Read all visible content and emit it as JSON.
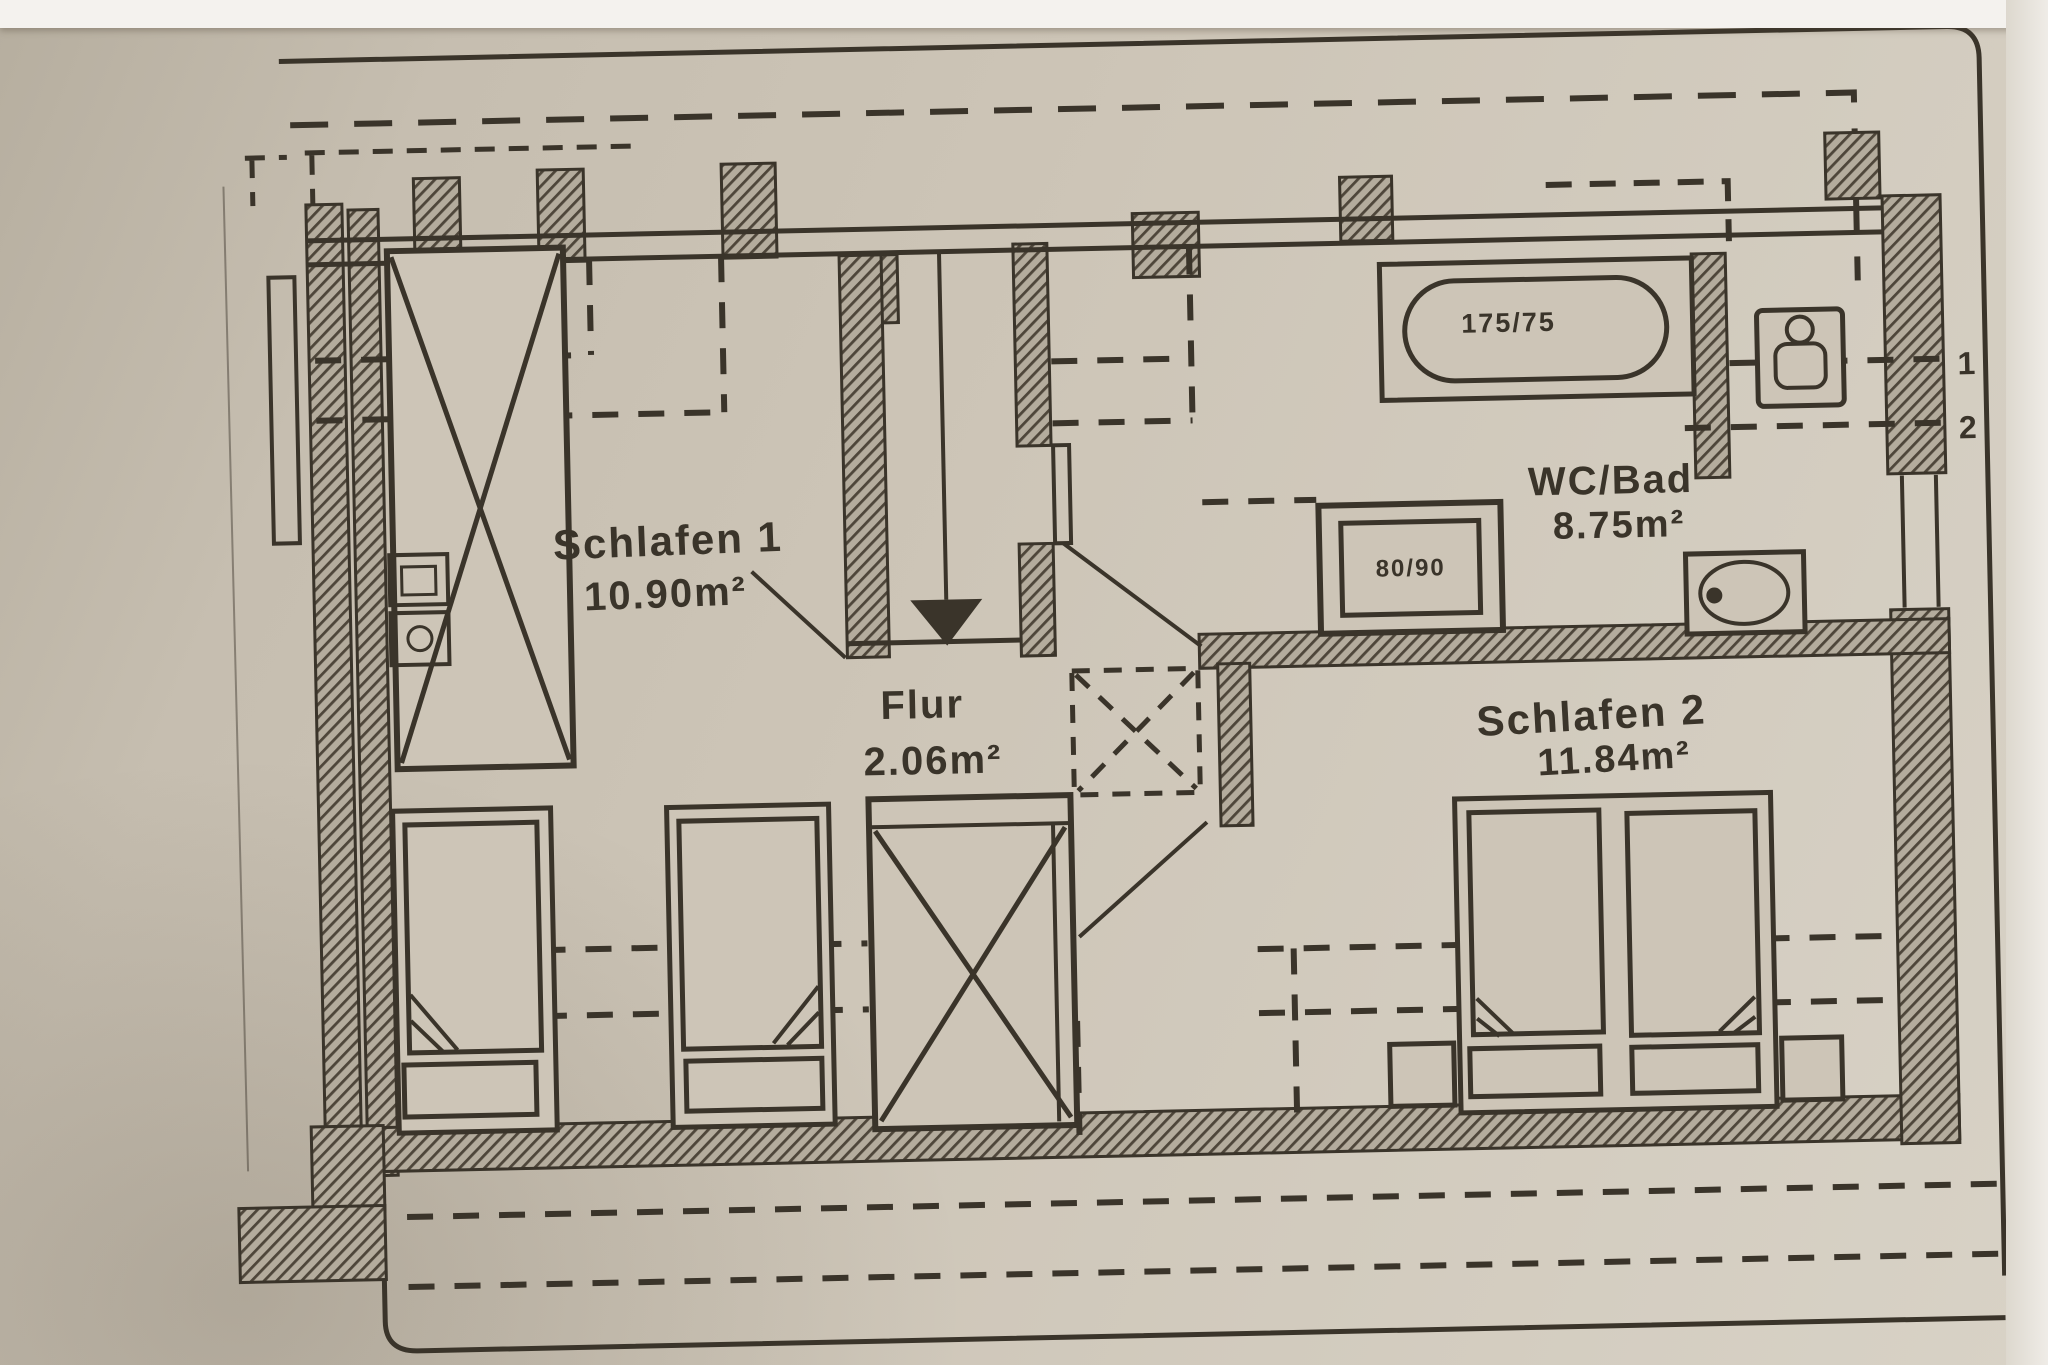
{
  "plan": {
    "rooms": [
      {
        "name": "Schlafen 1",
        "area": "10.90m²"
      },
      {
        "name": "Flur",
        "area": "2.06m²"
      },
      {
        "name": "WC/Bad",
        "area": "8.75m²"
      },
      {
        "name": "Schlafen 2",
        "area": "11.84m²"
      }
    ],
    "fixtures": {
      "bathtub_label": "175/75",
      "shower_label": "80/90"
    },
    "markers": {
      "right": [
        "1",
        "2"
      ]
    },
    "colors": {
      "paper": "#cdc5b7",
      "ink": "#3a342a"
    }
  }
}
